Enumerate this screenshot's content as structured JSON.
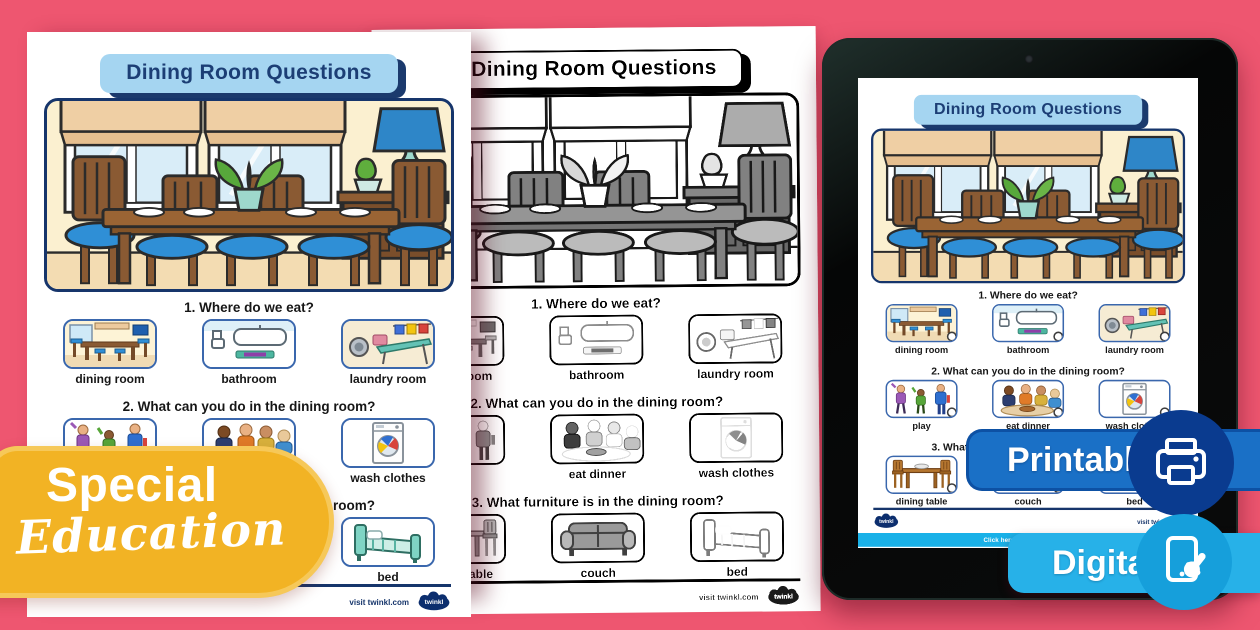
{
  "worksheet": {
    "title": "Dining Room Questions",
    "brand": "twinkl",
    "footer_link": "visit twinkl.com",
    "questions": [
      {
        "text": "1. Where do we eat?",
        "options": [
          {
            "label": "dining room"
          },
          {
            "label": "bathroom"
          },
          {
            "label": "laundry room"
          }
        ]
      },
      {
        "text": "2. What can you do in the dining room?",
        "options": [
          {
            "label": "play"
          },
          {
            "label": "eat dinner"
          },
          {
            "label": "wash clothes"
          }
        ]
      },
      {
        "text": "3. What furniture is in the dining room?",
        "options": [
          {
            "label": "dining table"
          },
          {
            "label": "couch"
          },
          {
            "label": "bed"
          }
        ]
      }
    ]
  },
  "tablet": {
    "bar_text": "Click here for the full version"
  },
  "badges": {
    "category_line1": "Special",
    "category_line2": "Education",
    "printable": "Printable",
    "digital": "Digital"
  },
  "icons": {
    "printer": "printer-icon",
    "tablet_touch": "tablet-touch-icon",
    "camera": "camera-icon",
    "twinkl_cloud": "twinkl-logo"
  },
  "colors": {
    "background_pink": "#ee5670",
    "title_plate_blue": "#a5d5f1",
    "title_text_navy": "#1c3e75",
    "category_badge_yellow": "#f2b324",
    "printable_blue": "#1a70c6",
    "printable_circle_navy": "#0a3b8f",
    "digital_cyan": "#27b1e8",
    "digital_circle_blue": "#169fdb",
    "option_border_blue": "#3a67ad",
    "tablet_bar_cyan": "#19b1e8"
  }
}
